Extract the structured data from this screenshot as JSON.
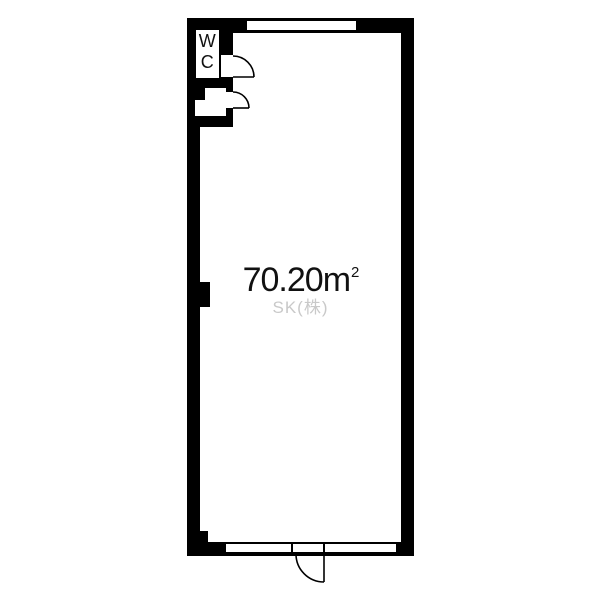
{
  "floorplan": {
    "wc_label": "WC",
    "area": {
      "value": "70.20",
      "unit": "m",
      "exponent": "2"
    },
    "watermark": "SK(株)",
    "colors": {
      "wall": "#000000",
      "floor": "#ffffff",
      "area_text": "#111111",
      "watermark_text": "#c9c9c9"
    }
  }
}
